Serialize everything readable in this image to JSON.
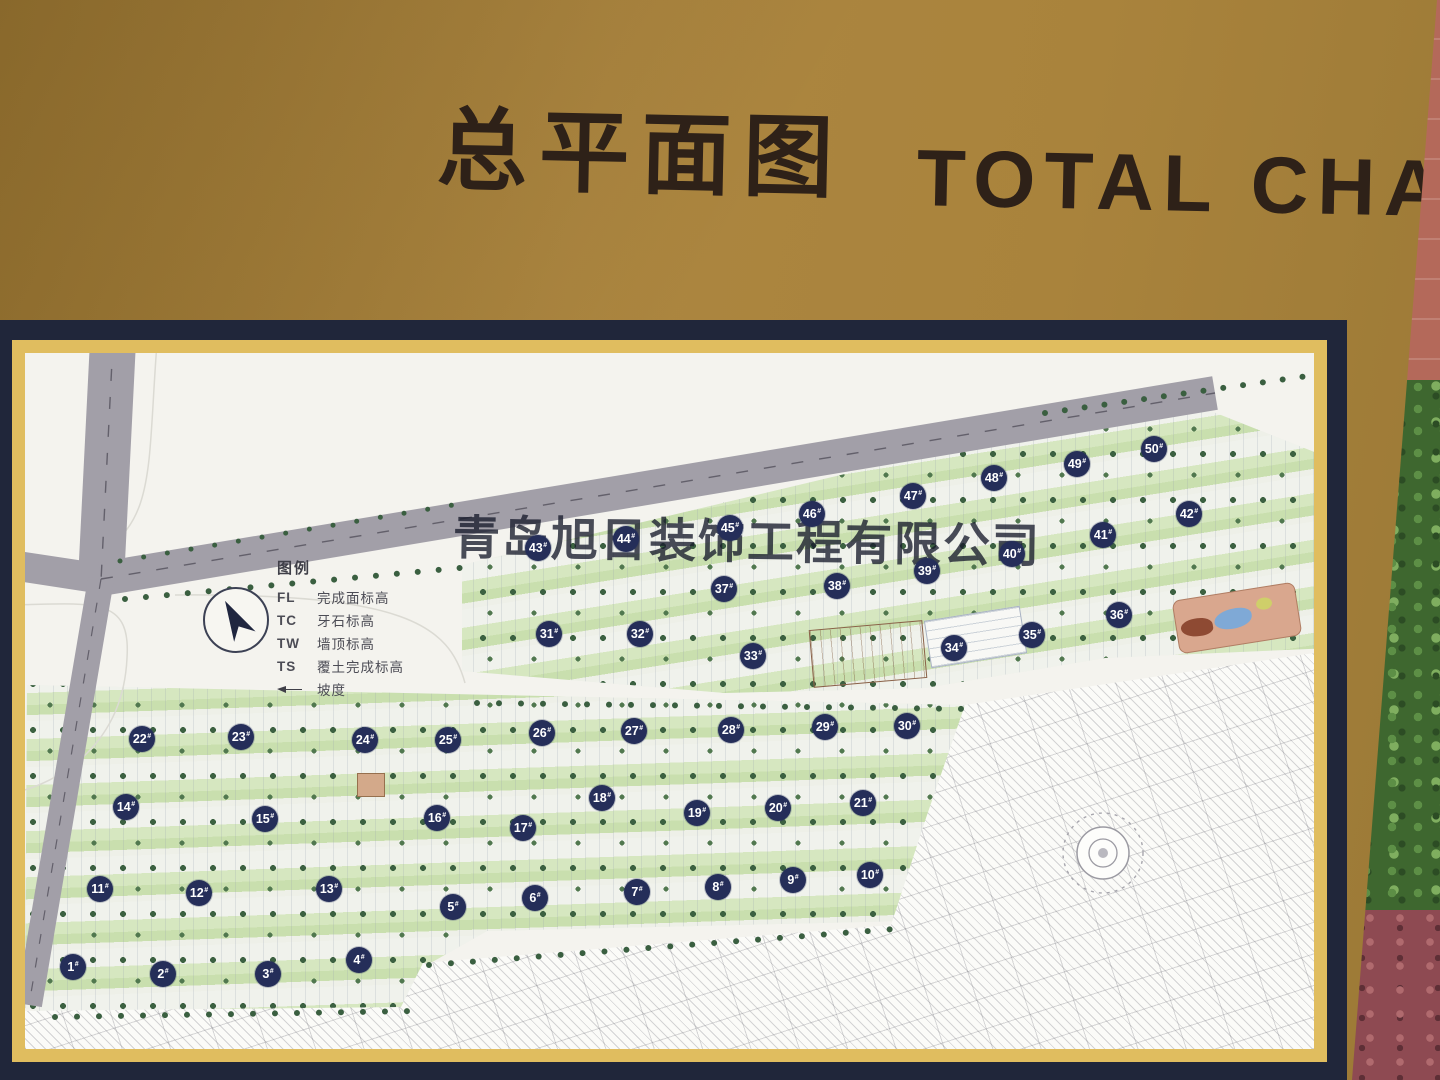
{
  "board": {
    "title_zh": "总平面图",
    "title_en": "TOTAL CHART"
  },
  "watermark": "青岛旭日装饰工程有限公司",
  "legend": {
    "heading": "图例",
    "items": [
      {
        "key": "FL",
        "label": "完成面标高"
      },
      {
        "key": "TC",
        "label": "牙石标高"
      },
      {
        "key": "TW",
        "label": "墙顶标高"
      },
      {
        "key": "TS",
        "label": "覆土完成标高"
      },
      {
        "key": "",
        "label": "坡度"
      }
    ]
  },
  "colors": {
    "board_gold": "#a9833c",
    "frame_navy": "#20263a",
    "mat_gold": "#e0bd5f",
    "map_paper": "#f4f3ee",
    "badge_navy": "#252e59",
    "road_gray": "#a29fa8",
    "greenery": "#cfe2b6",
    "tree_green": "#3c6141",
    "wall_red": "#b4695a",
    "foliage_green": "#3e672f",
    "title_brown": "#2e2118"
  },
  "map": {
    "badge_suffix": "#",
    "buildings": [
      {
        "label": "1",
        "x": 48,
        "y": 614
      },
      {
        "label": "2",
        "x": 138,
        "y": 621
      },
      {
        "label": "3",
        "x": 243,
        "y": 621
      },
      {
        "label": "4",
        "x": 334,
        "y": 607
      },
      {
        "label": "5",
        "x": 428,
        "y": 554
      },
      {
        "label": "6",
        "x": 510,
        "y": 545
      },
      {
        "label": "7",
        "x": 612,
        "y": 539
      },
      {
        "label": "8",
        "x": 693,
        "y": 534
      },
      {
        "label": "9",
        "x": 768,
        "y": 527
      },
      {
        "label": "10",
        "x": 845,
        "y": 522
      },
      {
        "label": "11",
        "x": 75,
        "y": 536
      },
      {
        "label": "12",
        "x": 174,
        "y": 540
      },
      {
        "label": "13",
        "x": 304,
        "y": 536
      },
      {
        "label": "14",
        "x": 101,
        "y": 454
      },
      {
        "label": "15",
        "x": 240,
        "y": 466
      },
      {
        "label": "16",
        "x": 412,
        "y": 465
      },
      {
        "label": "17",
        "x": 498,
        "y": 475
      },
      {
        "label": "18",
        "x": 577,
        "y": 445
      },
      {
        "label": "19",
        "x": 672,
        "y": 460
      },
      {
        "label": "20",
        "x": 753,
        "y": 455
      },
      {
        "label": "21",
        "x": 838,
        "y": 450
      },
      {
        "label": "22",
        "x": 117,
        "y": 386
      },
      {
        "label": "23",
        "x": 216,
        "y": 384
      },
      {
        "label": "24",
        "x": 340,
        "y": 387
      },
      {
        "label": "25",
        "x": 423,
        "y": 387
      },
      {
        "label": "26",
        "x": 517,
        "y": 380
      },
      {
        "label": "27",
        "x": 609,
        "y": 378
      },
      {
        "label": "28",
        "x": 706,
        "y": 377
      },
      {
        "label": "29",
        "x": 800,
        "y": 374
      },
      {
        "label": "30",
        "x": 882,
        "y": 373
      },
      {
        "label": "31",
        "x": 524,
        "y": 281
      },
      {
        "label": "32",
        "x": 615,
        "y": 281
      },
      {
        "label": "33",
        "x": 728,
        "y": 303
      },
      {
        "label": "34",
        "x": 929,
        "y": 295
      },
      {
        "label": "35",
        "x": 1007,
        "y": 282
      },
      {
        "label": "36",
        "x": 1094,
        "y": 262
      },
      {
        "label": "37",
        "x": 699,
        "y": 236
      },
      {
        "label": "38",
        "x": 812,
        "y": 233
      },
      {
        "label": "39",
        "x": 902,
        "y": 218
      },
      {
        "label": "40",
        "x": 987,
        "y": 201
      },
      {
        "label": "41",
        "x": 1078,
        "y": 182
      },
      {
        "label": "42",
        "x": 1164,
        "y": 161
      },
      {
        "label": "43",
        "x": 513,
        "y": 195
      },
      {
        "label": "44",
        "x": 601,
        "y": 186
      },
      {
        "label": "45",
        "x": 705,
        "y": 175
      },
      {
        "label": "46",
        "x": 787,
        "y": 161
      },
      {
        "label": "47",
        "x": 888,
        "y": 143
      },
      {
        "label": "48",
        "x": 969,
        "y": 125
      },
      {
        "label": "49",
        "x": 1052,
        "y": 111
      },
      {
        "label": "50",
        "x": 1129,
        "y": 96
      }
    ]
  }
}
